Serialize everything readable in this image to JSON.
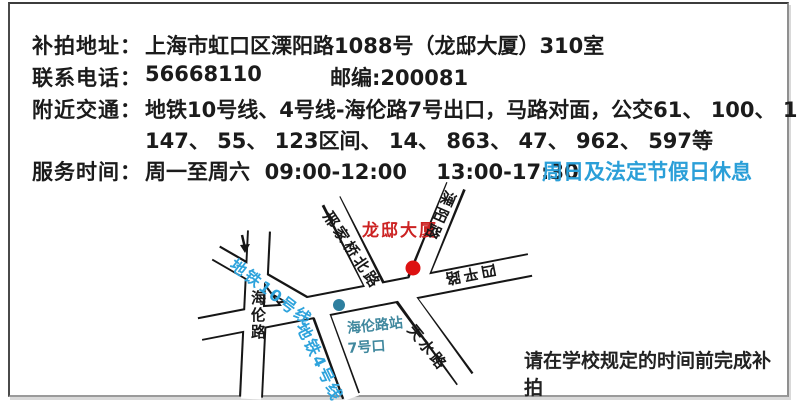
{
  "info": {
    "address_label": "补拍地址：",
    "address_value": "上海市虹口区溧阳路1088号（龙邸大厦）310室",
    "phone_label": "联系电话：",
    "phone_value": "56668110",
    "postal_value": "邮编:200081",
    "transport_label": "附近交通：",
    "transport_line1": "地铁10号线、4号线-海伦路7号出口，马路对面，公交61、 100、 123、",
    "transport_line2": "147、 55、 123区间、 14、 863、 47、 962、 597等",
    "hours_label": "服务时间：",
    "hours_value": "周一至周六  09:00-12:00    13:00-17:30",
    "hours_closed": "周日及法定节假日休息"
  },
  "map": {
    "building": "龙邸大厦",
    "road_xingjiaqiaobei": "邢家桥北路",
    "road_liyang": "溧阳路",
    "road_siping": "四平路",
    "road_hailun": "海伦路",
    "road_tianshui": "天水路",
    "metro_line10": "地铁10号线",
    "metro_line4": "地铁4号线",
    "station_name": "海伦路站",
    "station_exit": "7号口"
  },
  "note": "请在学校规定的时间前完成补拍",
  "colors": {
    "highlight_blue": "#2b9fd8",
    "metro_blue": "#2ea3dc",
    "station_teal": "#40889e",
    "building_red": "#cc2222",
    "marker_red": "#dd1111",
    "marker_teal": "#2e7f9f"
  }
}
